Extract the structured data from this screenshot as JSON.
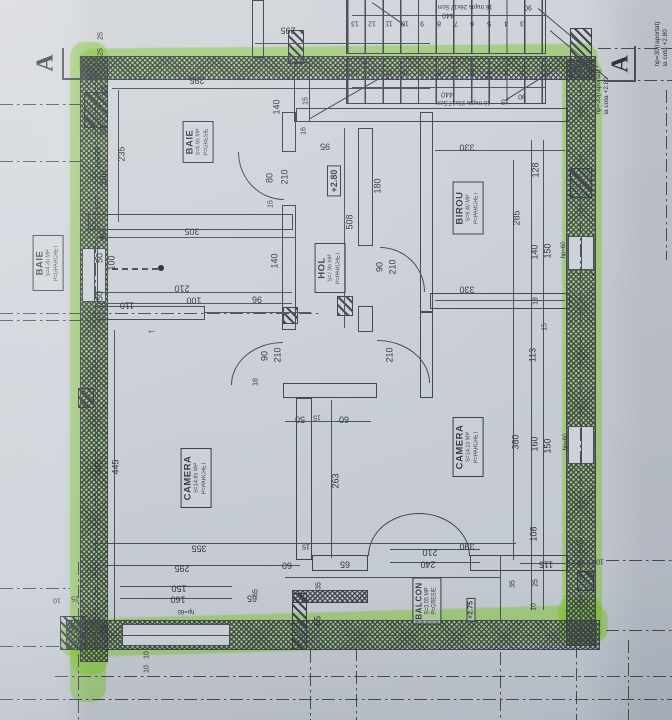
{
  "document": {
    "kind": "floor-plan photo",
    "section_marker": "A",
    "arrow_left": "←"
  },
  "colors": {
    "paper": "#ccd1d8",
    "ink": "#3f444c",
    "highlighter": "#7ec62c"
  },
  "rooms": {
    "baie1": {
      "name": "BAIE",
      "area": "S=4.30 MP",
      "floor": "P=GPARCHET"
    },
    "baie2": {
      "name": "BAIE",
      "area": "S=6.95 MP",
      "floor": "P=GRESIE"
    },
    "hol": {
      "name": "HOL",
      "area": "S=7.95 MP",
      "floor": "P=PARCHET"
    },
    "birou": {
      "name": "BIROU",
      "area": "S=9.40 MP",
      "floor": "P=PARCHET"
    },
    "camera1": {
      "name": "CAMERA",
      "area": "S=14.85 MP",
      "floor": "P=PARCHET"
    },
    "camera2": {
      "name": "CAMERA",
      "area": "S=14.15 MP",
      "floor": "P=PARCHET"
    },
    "balcon": {
      "name": "BALCON",
      "area": "S=3.05 MP",
      "floor": "P=GRESIE"
    }
  },
  "levels": {
    "hol": "+2.80",
    "balcon": "+2.75"
  },
  "stairs": {
    "numbers": [
      "13",
      "12",
      "11",
      "10",
      "9",
      "8",
      "7",
      "6",
      "5",
      "4",
      "3"
    ],
    "note": "16 trepte 26x17.5cm",
    "run": "440",
    "width": "90"
  },
  "annotations": {
    "hp30_line1": "hp=30(raportat)",
    "hp30_line2": "la cota +2.80"
  },
  "dims": [
    "295",
    "295",
    "440",
    "16 trepte 26x17.5cm",
    "90",
    "440",
    "16 trepte 26x17.5cm",
    "90",
    "25",
    "25",
    "65",
    "50",
    "hp=110",
    "100",
    "235",
    "15",
    "40",
    "50",
    "100",
    "50",
    "110",
    "445",
    "445",
    "305",
    "210",
    "100",
    "96",
    "140",
    "140",
    "15",
    "16",
    "15",
    "80",
    "210",
    "95",
    "508",
    "180",
    "90",
    "210",
    "330",
    "128",
    "285",
    "140",
    "150",
    "hp=60",
    "330",
    "18",
    "15",
    "113",
    "90",
    "210",
    "210",
    "18",
    "50",
    "15",
    "60",
    "263",
    "380",
    "160",
    "150",
    "hp=60",
    "355",
    "295",
    "150",
    "160",
    "hp=60",
    "65",
    "60",
    "15",
    "65",
    "35",
    "65",
    "25",
    "10",
    "15",
    "25",
    "10",
    "10",
    "390",
    "210",
    "240",
    "108",
    "35",
    "115",
    "25",
    "10",
    "35",
    "25",
    "10",
    "65",
    "15"
  ]
}
